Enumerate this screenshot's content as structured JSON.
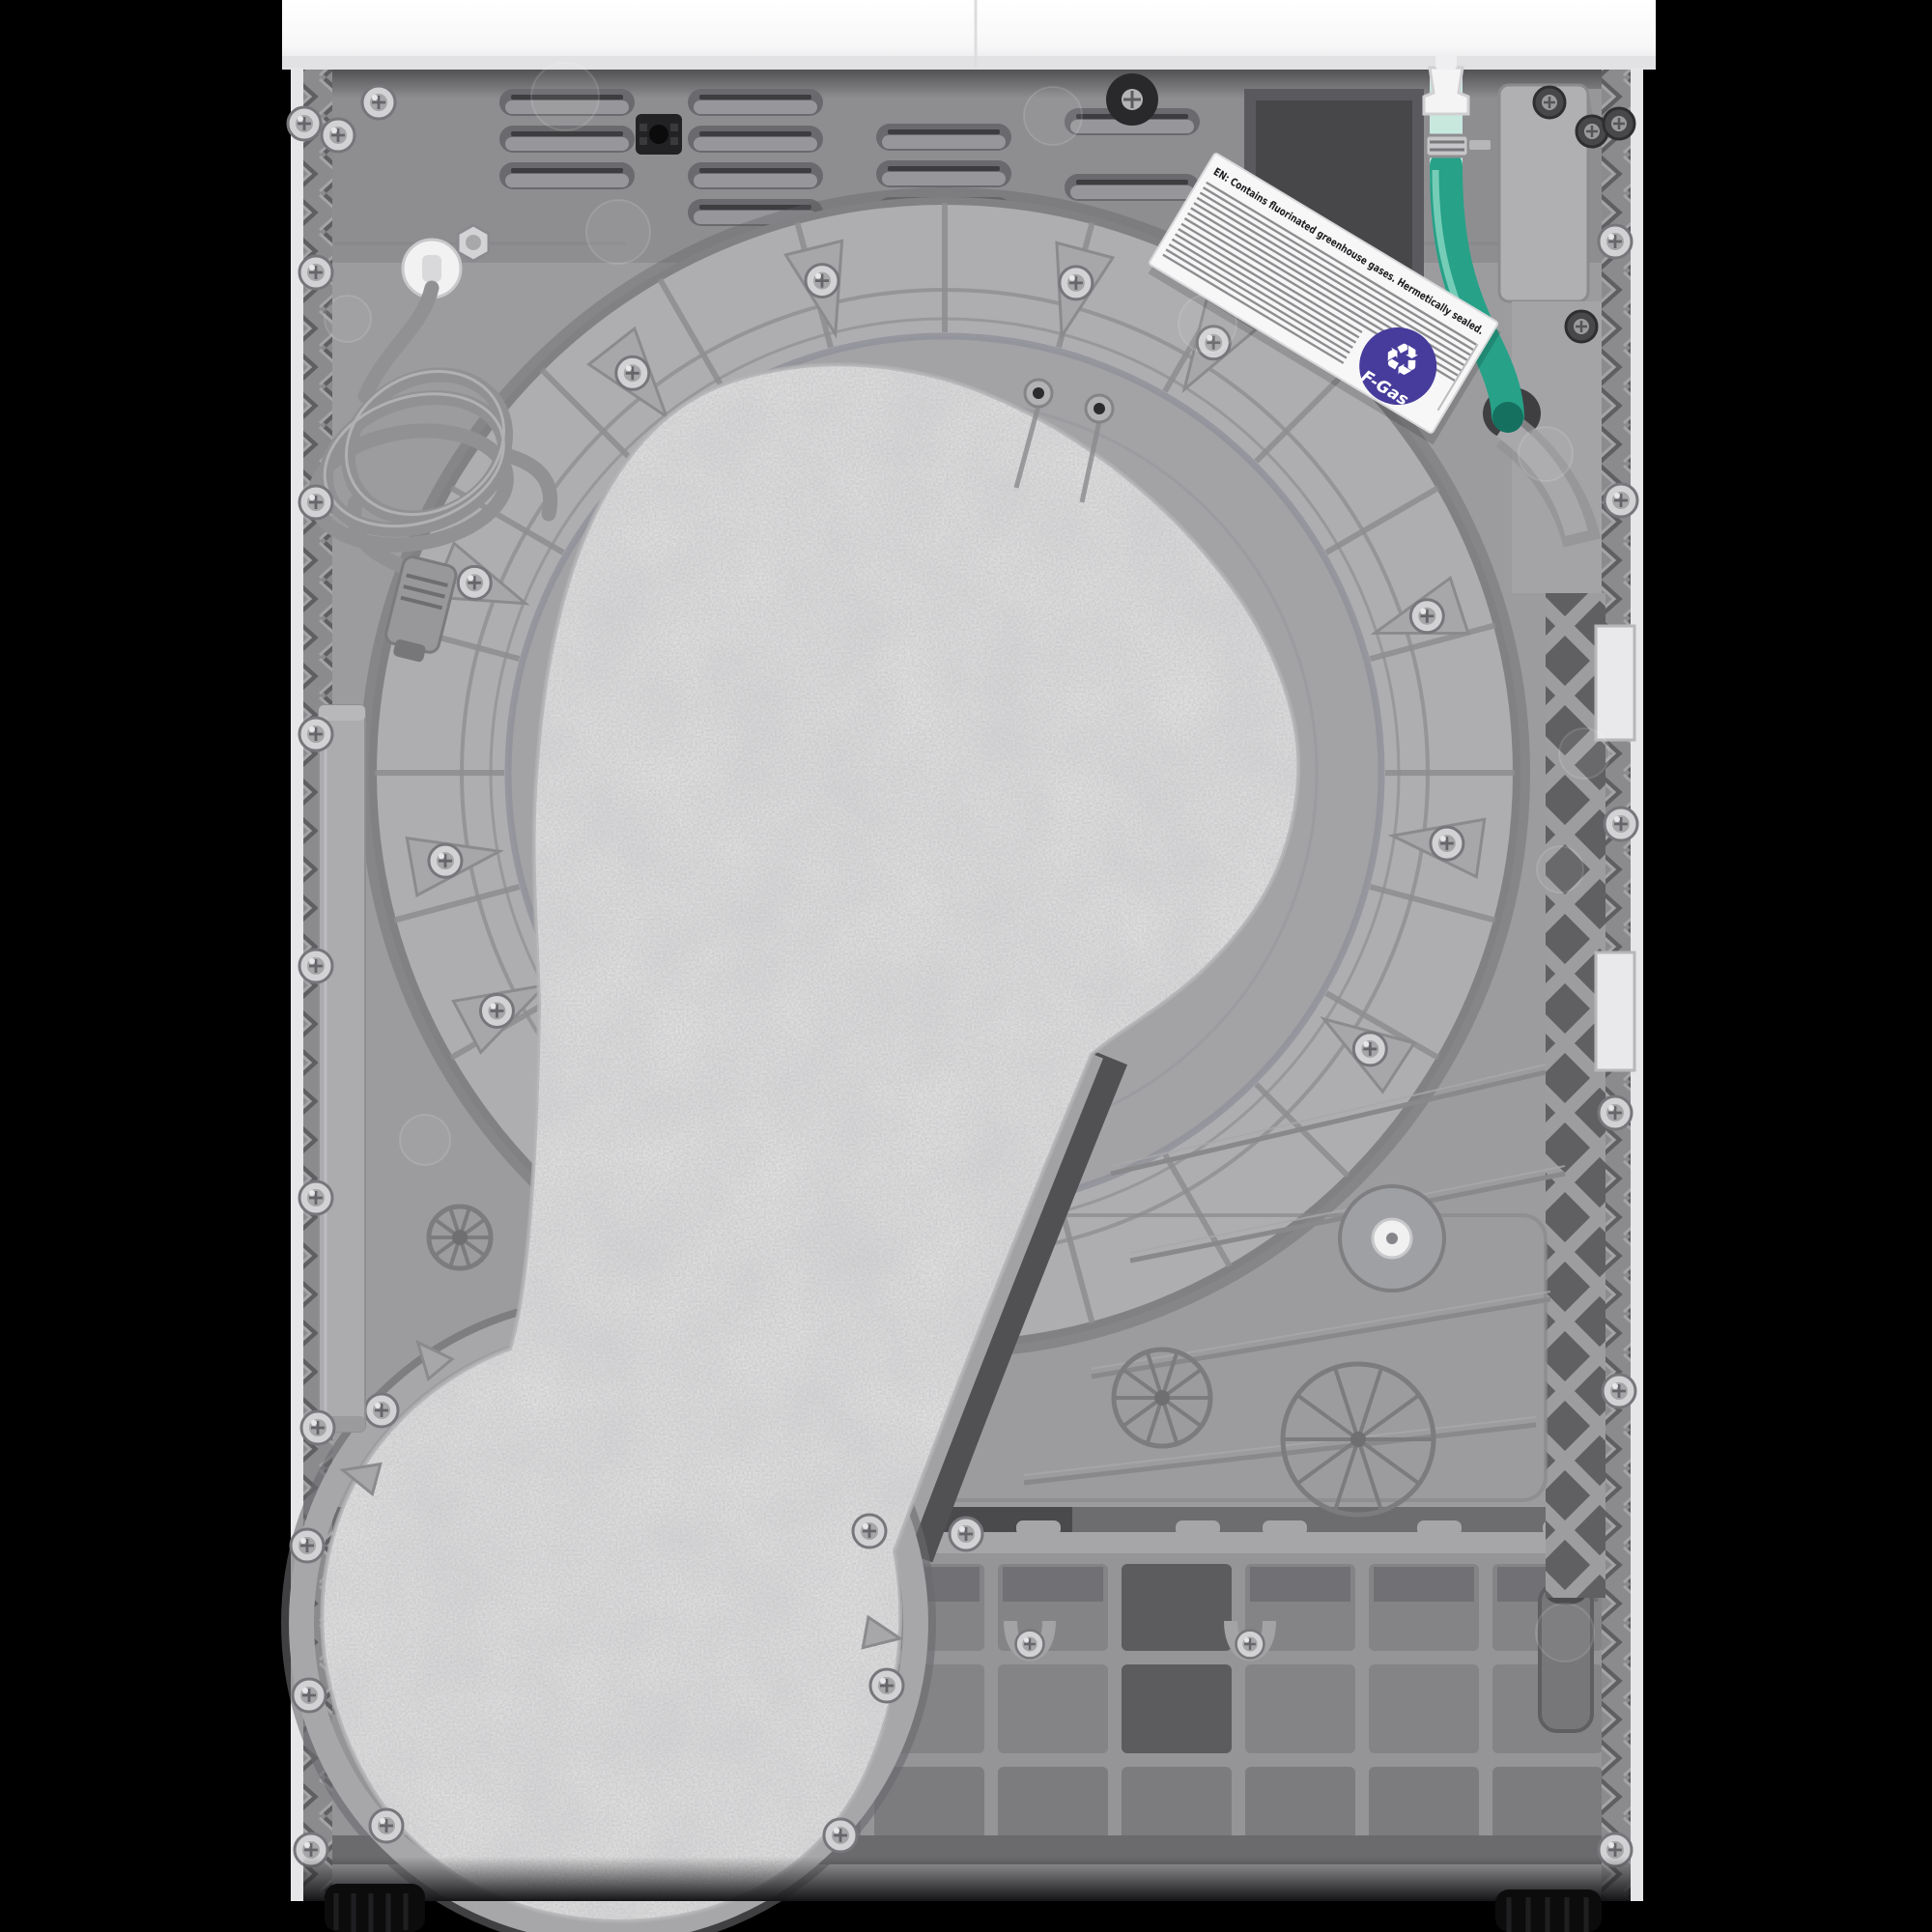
{
  "meta": {
    "subject": "Rear view of a heat-pump tumble dryer (product photo)",
    "background": "#000000"
  },
  "palette": {
    "top_deck_white": "#fbfbfc",
    "side_panel_white": "#e8e8ea",
    "rear_panel_grey": "#9c9c9f",
    "upper_panel_grey": "#8e8e91",
    "drum_ring_grey": "#aeaeb1",
    "drum_dome_grey": "#a3a3a6",
    "felt_pad_grey": "#e0e0e0",
    "base_grey": "#939396",
    "lattice_dark_grey": "#636366",
    "vent_recess_grey": "#6a6a6e",
    "power_cord_grey": "#919194",
    "drain_hose_green": "#27a188",
    "hose_pale_green": "#c8e8de",
    "connector_white": "#f4f4f5",
    "label_white": "#f7f7f8",
    "fgas_badge_purple": "#473c9b",
    "foot_black": "#0c0c0d"
  },
  "label": {
    "heading": "EN: Contains fluorinated greenhouse gases. Hermetically sealed.",
    "badge_text": "F-Gas",
    "recycle_glyph": "♻"
  }
}
